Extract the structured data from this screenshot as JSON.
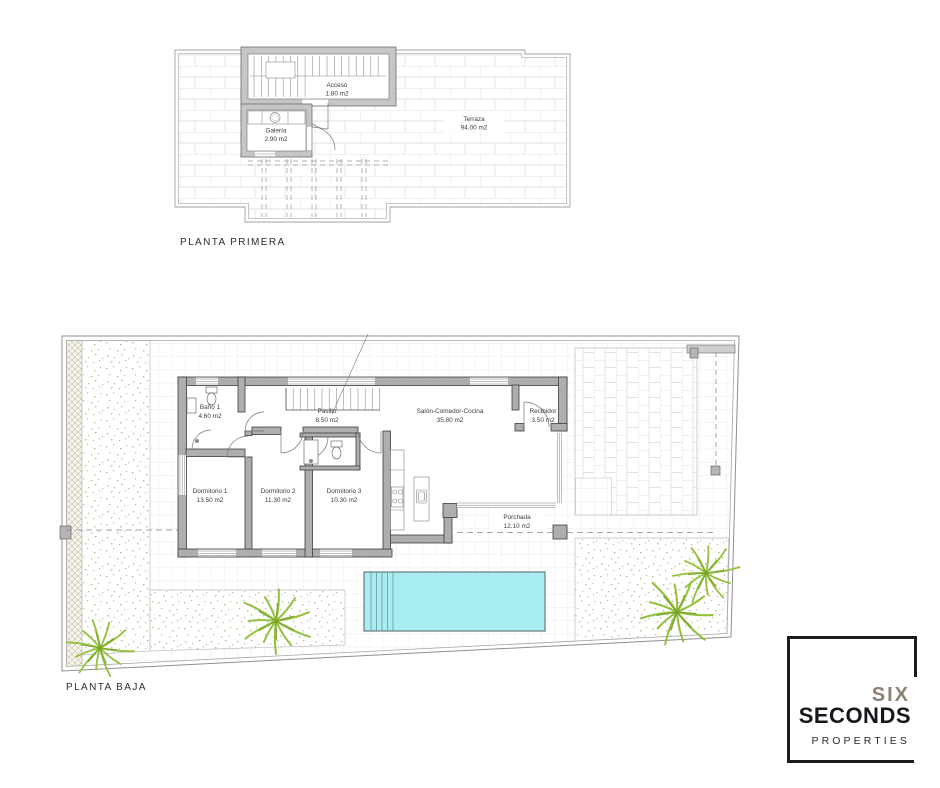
{
  "plans": {
    "planta_primera": {
      "caption": "PLANTA PRIMERA",
      "rooms": {
        "acceso": {
          "name": "Acceso",
          "area": "1.80 m2"
        },
        "galeria": {
          "name": "Galería",
          "area": "2.90 m2"
        },
        "terraza": {
          "name": "Terraza",
          "area": "94.00 m2"
        }
      }
    },
    "planta_baja": {
      "caption": "PLANTA BAJA",
      "rooms": {
        "bano1": {
          "name": "Baño 1",
          "area": "4.60 m2"
        },
        "pasillo": {
          "name": "Pasillo",
          "area": "8.50 m2"
        },
        "salon": {
          "name": "Salón-Comedor-Cocina",
          "area": "35.80 m2"
        },
        "recibidor": {
          "name": "Recibidor",
          "area": "3.50 m2"
        },
        "dormitorio1": {
          "name": "Dormitorio 1",
          "area": "13.50 m2"
        },
        "dormitorio2": {
          "name": "Dormitorio 2",
          "area": "11.30 m2"
        },
        "dormitorio3": {
          "name": "Dormitorio 3",
          "area": "10.30 m2"
        },
        "porchada": {
          "name": "Porchada",
          "area": "12.10 m2"
        }
      }
    }
  },
  "logo": {
    "line1": "SIX",
    "line2": "SECONDS",
    "line3": "PROPERTIES"
  },
  "colors": {
    "pool": "#a7edf2",
    "pool_edge": "#6f8488",
    "palm_green": "#94c13d",
    "palm_dark": "#7aa32c",
    "wall_fill": "#aeaeae",
    "wall_stroke": "#3d3d3d",
    "boundary_gray": "#909090",
    "logo_six": "#8c8174",
    "logo_dark": "#16161d"
  }
}
